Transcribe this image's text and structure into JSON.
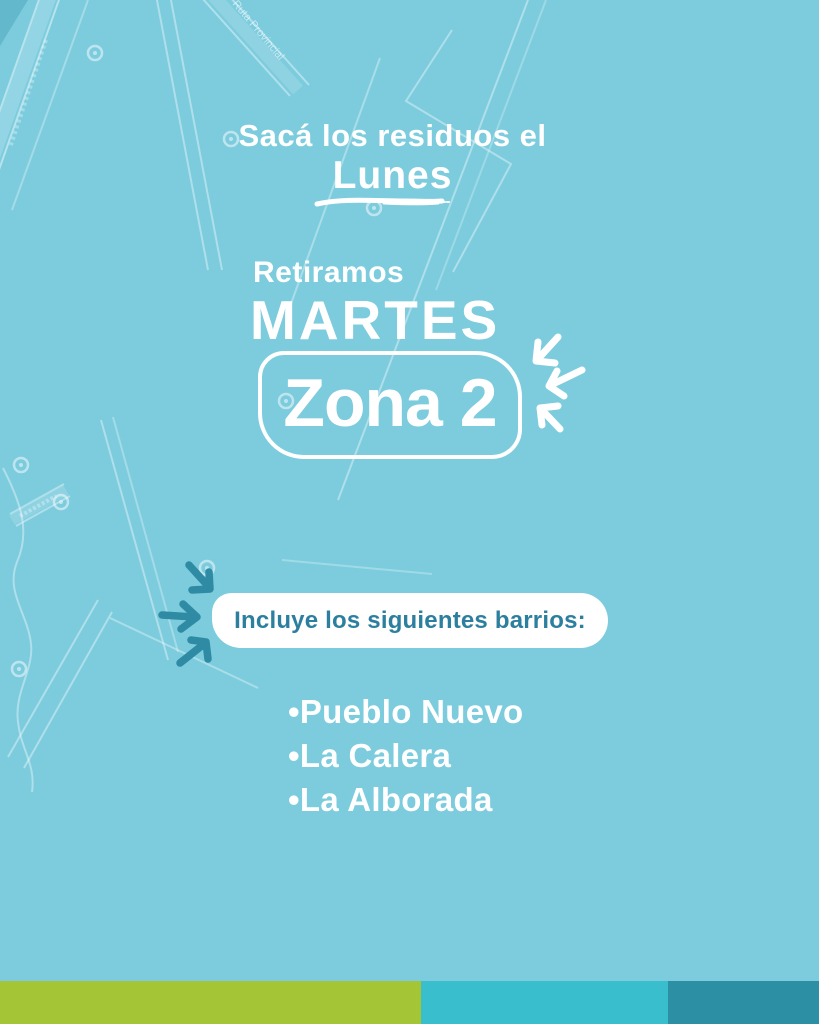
{
  "poster": {
    "headline": "Sacá los residuos el",
    "headline_day": "Lunes",
    "pickup_label": "Retiramos",
    "pickup_day": "MARTES",
    "zone_label": "Zona 2",
    "neighborhoods_title": "Incluye los siguientes barrios:",
    "bullet": "•",
    "neighborhoods": [
      "Pueblo Nuevo",
      "La Calera",
      "La Alborada"
    ]
  },
  "map": {
    "road_label": "Ruta Provincial"
  },
  "colors": {
    "background": "#7CCCDE",
    "text_white": "#FFFFFF",
    "pill_background": "#FFFFFF",
    "pill_text_teal": "#2C7F9E",
    "arrow_teal": "#2E8BA3",
    "map_lines": "rgba(255,255,255,0.4)",
    "footer_green": "#A3C536",
    "footer_teal": "#39BECD",
    "footer_dark_teal": "#2D8FA4"
  }
}
